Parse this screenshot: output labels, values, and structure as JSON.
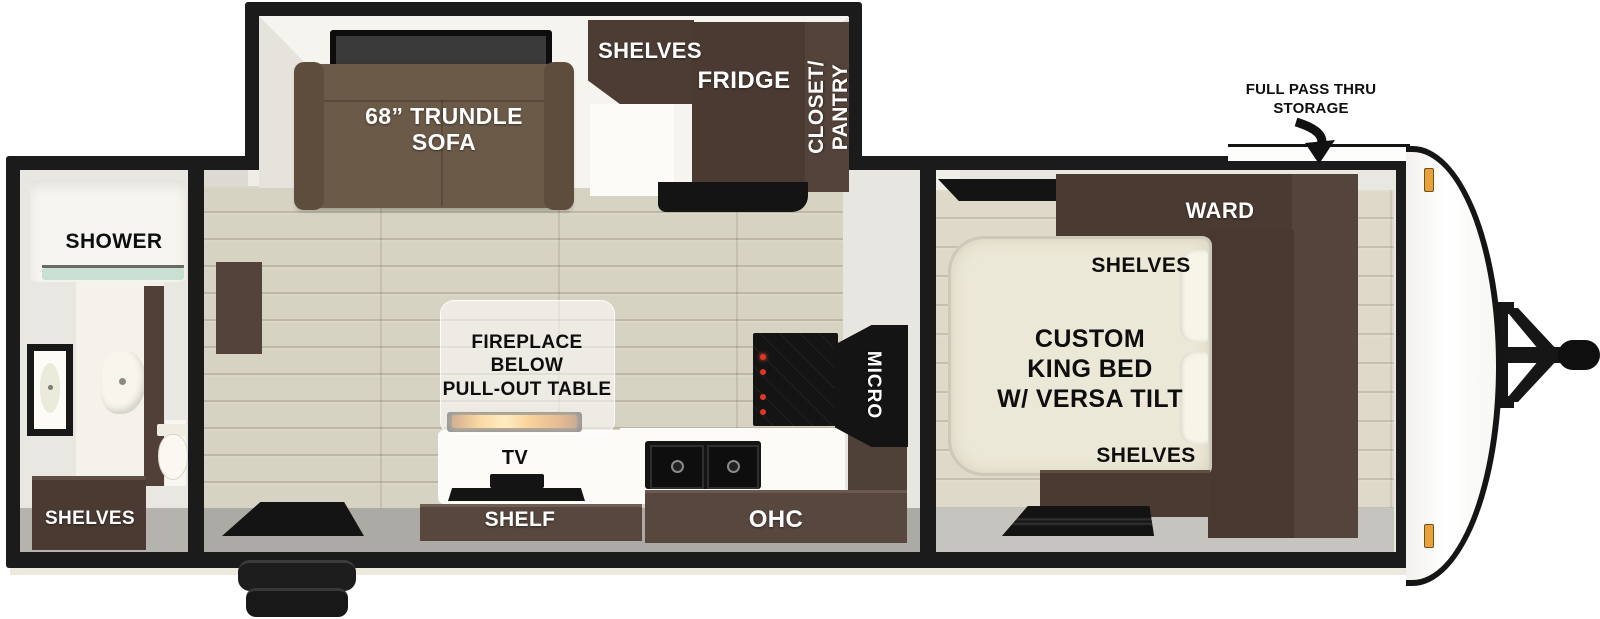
{
  "title": "Travel trailer floor plan",
  "colors": {
    "wall_black": "#1b1b1c",
    "interior_white": "#e9e7e1",
    "floor_tan": "#d7d3c3",
    "cabinet_dark_brown": "#4a3a32",
    "cabinet_brown": "#57473e",
    "sofa_brown": "#6b5a48",
    "bed_cream": "#ece8d7",
    "counter_white": "#fcfbf7",
    "appliance_black": "#141414",
    "flame_orange": "#f09a20",
    "marker_amber": "#e7a23b"
  },
  "exterior": {
    "storage_label": "FULL PASS THRU\nSTORAGE"
  },
  "bathroom": {
    "shower_label": "SHOWER",
    "shelves_label": "SHELVES"
  },
  "living": {
    "sofa_label": "68” TRUNDLE\nSOFA",
    "shelves_label": "SHELVES",
    "fridge_label": "FRIDGE",
    "closet_pantry_label": "CLOSET/\nPANTRY",
    "fireplace_label": "FIREPLACE\nBELOW\nPULL-OUT TABLE",
    "tv_label": "TV",
    "shelf_label": "SHELF",
    "ohc_label": "OHC",
    "micro_label": "MICRO"
  },
  "bedroom": {
    "ward_label": "WARD",
    "shelves_upper_label": "SHELVES",
    "bed_label": "CUSTOM\nKING BED\nW/ VERSA TILT",
    "shelves_lower_label": "SHELVES"
  }
}
